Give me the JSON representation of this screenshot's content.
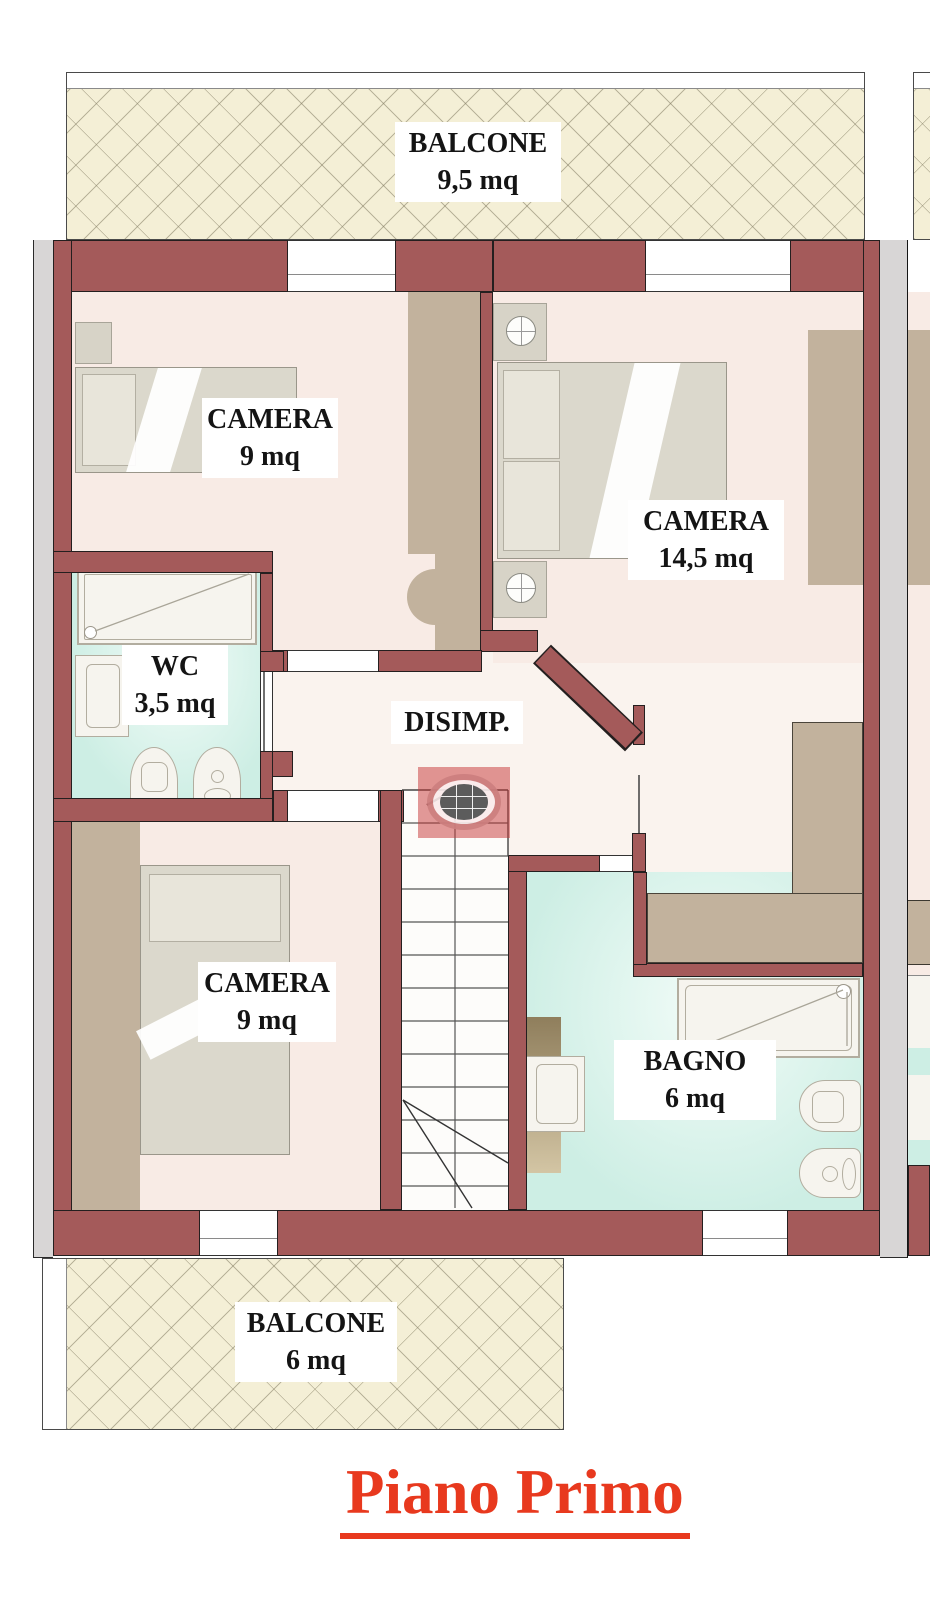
{
  "floorplan": {
    "title": "Piano Primo",
    "title_color": "#e8391e",
    "rooms": [
      {
        "id": "balcone_top",
        "name": "BALCONE",
        "area": "9,5 mq"
      },
      {
        "id": "camera_top_left",
        "name": "CAMERA",
        "area": "9 mq"
      },
      {
        "id": "camera_top_right",
        "name": "CAMERA",
        "area": "14,5 mq"
      },
      {
        "id": "wc",
        "name": "WC",
        "area": "3,5 mq"
      },
      {
        "id": "disimpegno",
        "name": "DISIMP.",
        "area": ""
      },
      {
        "id": "camera_bottom_left",
        "name": "CAMERA",
        "area": "9 mq"
      },
      {
        "id": "bagno",
        "name": "BAGNO",
        "area": "6 mq"
      },
      {
        "id": "balcone_bottom",
        "name": "BALCONE",
        "area": "6 mq"
      }
    ],
    "icons": {
      "stairs_direction_arrow": "chevron-up",
      "watermark_logo": "globe-badge"
    },
    "colors": {
      "wall": "#a45a5a",
      "room_floor": "#f8ebe5",
      "bath_floor": "#cdeee4",
      "wardrobe": "#c2b29d",
      "balcony": "#f4efd6",
      "neighbor_strip": "#d8d6d6"
    }
  }
}
